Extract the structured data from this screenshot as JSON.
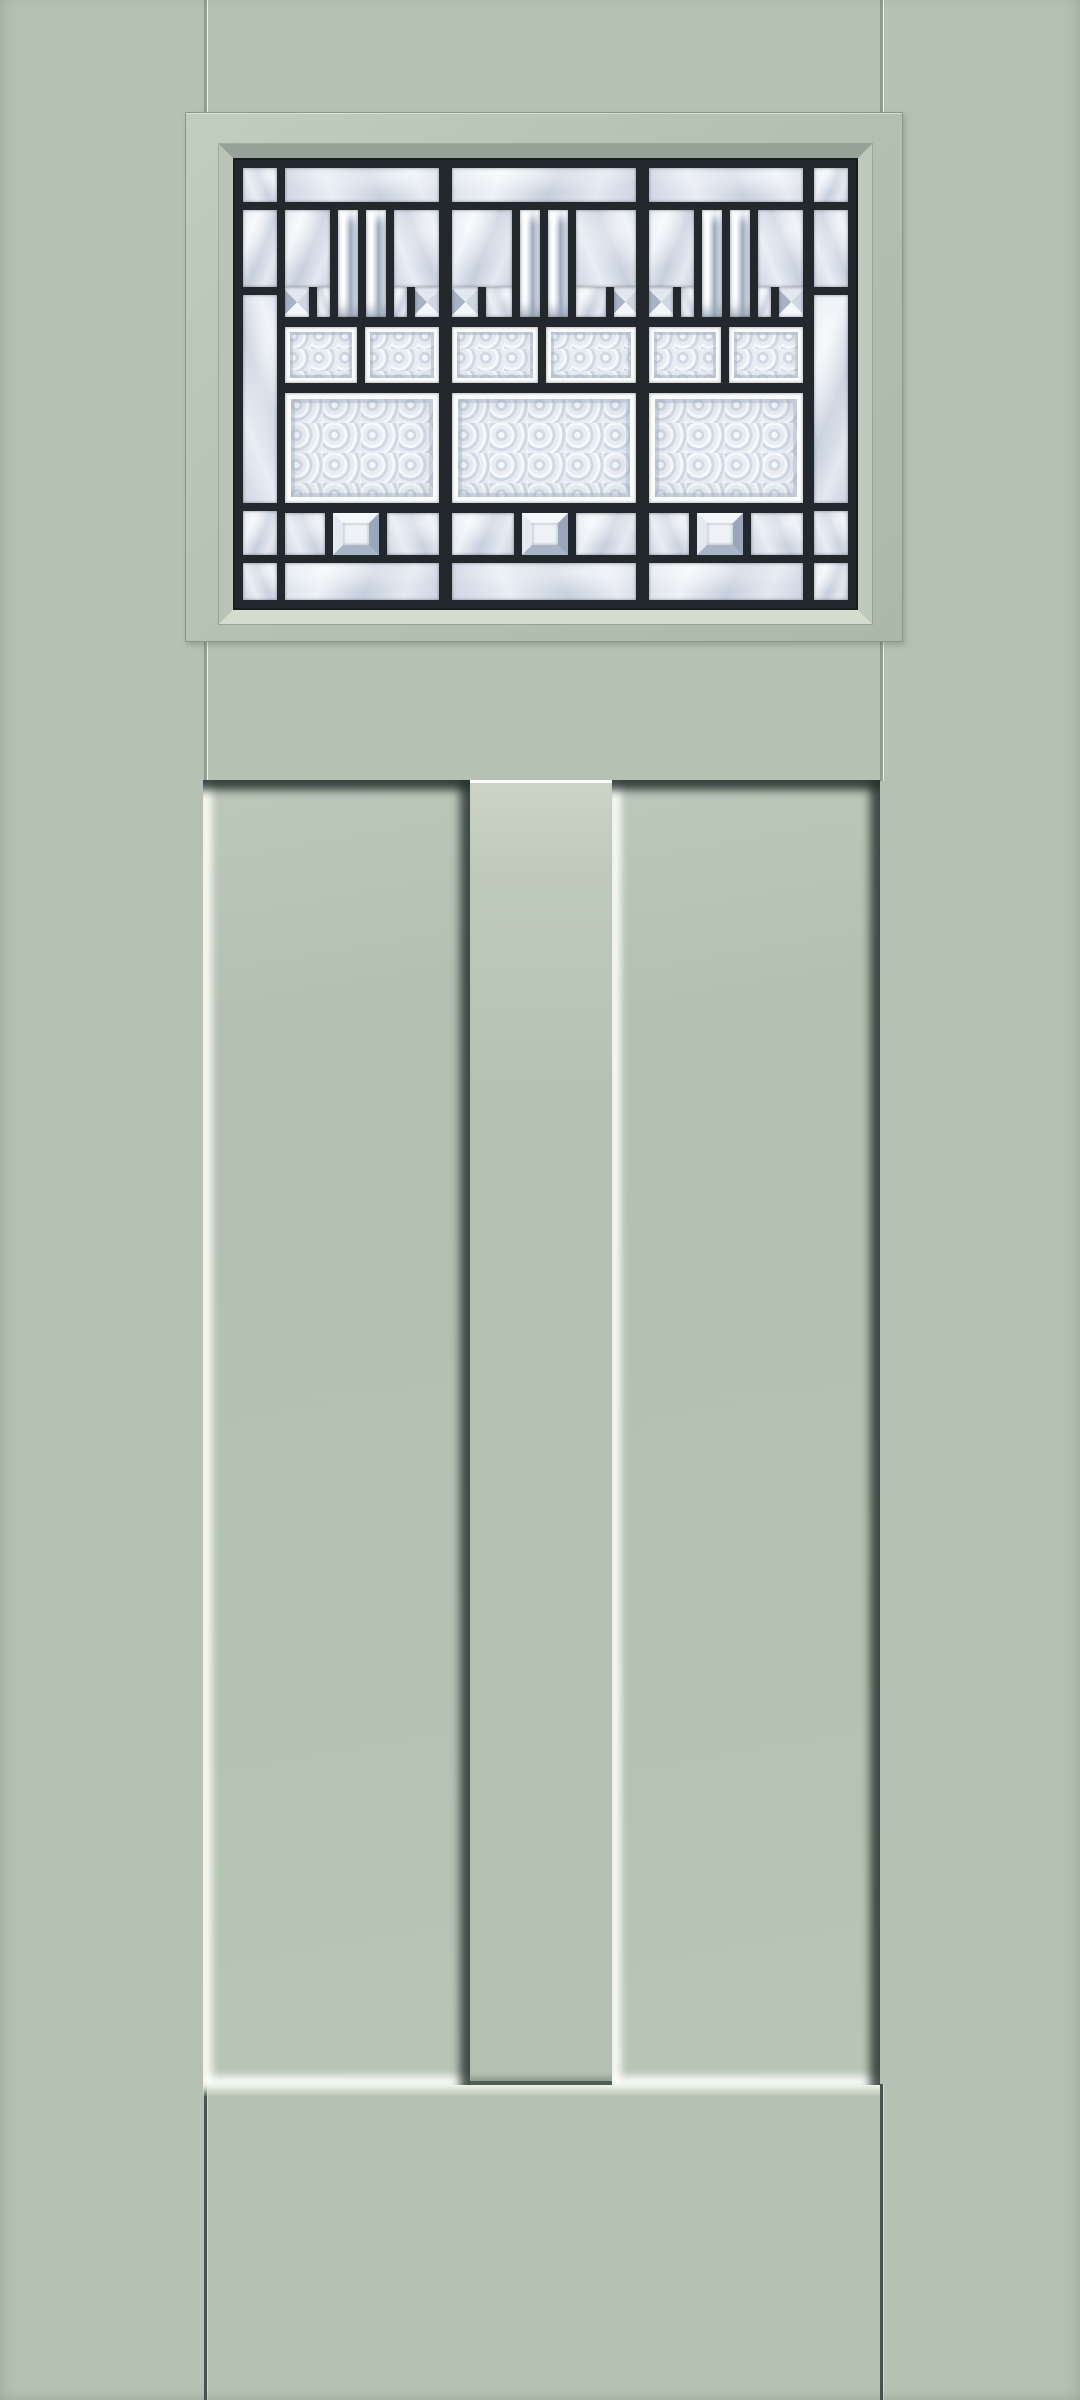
{
  "scene": {
    "description": "Product image of an exterior craftsman-style door, painted sage green, with a decorative leaded art-glass window above two tall recessed flat panels",
    "door_style": "craftsman two-panel, quarter-light decorative glass",
    "text_content": "none - image contains no text"
  },
  "colors": {
    "door_green": "#b5c2b3",
    "groove_gray": "#8a968b",
    "groove_dark": "#46544e",
    "molding_line": "#8b978c",
    "caming": "#22282b",
    "highlight": "#fafcf6",
    "recess_shadow": "#31403b",
    "glass_clear": "#dfe5ee",
    "glass_bevel_dark": "#9facbe",
    "glass_texture": "#e3e9f0"
  },
  "window": {
    "molding": {
      "shape": "rectangular flat molding",
      "color_ref": "door_green"
    },
    "glass": {
      "style": "craftsman leaded glass: side light columns, twin bevel prisms, dentil bevels, glue-chip blocks, large textured panes, bevel squares, clear border rows",
      "caming_color_ref": "caming",
      "pane_types": [
        "clear",
        "bar",
        "pyr",
        "bsq",
        "gr",
        "grb"
      ],
      "panes": [
        {
          "x": 10,
          "y": 10,
          "w": 34,
          "h": 34,
          "t": "clear"
        },
        {
          "x": 10,
          "y": 52,
          "w": 34,
          "h": 77,
          "t": "clear"
        },
        {
          "x": 10,
          "y": 137,
          "w": 34,
          "h": 208,
          "t": "clear"
        },
        {
          "x": 10,
          "y": 353,
          "w": 34,
          "h": 44,
          "t": "clear"
        },
        {
          "x": 10,
          "y": 405,
          "w": 34,
          "h": 37,
          "t": "clear"
        },
        {
          "x": 581,
          "y": 10,
          "w": 34,
          "h": 34,
          "t": "clear"
        },
        {
          "x": 581,
          "y": 52,
          "w": 34,
          "h": 77,
          "t": "clear"
        },
        {
          "x": 581,
          "y": 137,
          "w": 34,
          "h": 208,
          "t": "clear"
        },
        {
          "x": 581,
          "y": 353,
          "w": 34,
          "h": 44,
          "t": "clear"
        },
        {
          "x": 581,
          "y": 405,
          "w": 34,
          "h": 37,
          "t": "clear"
        },
        {
          "x": 52,
          "y": 10,
          "w": 154,
          "h": 34,
          "t": "clear"
        },
        {
          "x": 219,
          "y": 10,
          "w": 184,
          "h": 34,
          "t": "clear"
        },
        {
          "x": 416,
          "y": 10,
          "w": 154,
          "h": 34,
          "t": "clear"
        },
        {
          "x": 52,
          "y": 52,
          "w": 45,
          "h": 77,
          "t": "clear"
        },
        {
          "x": 161,
          "y": 52,
          "w": 45,
          "h": 77,
          "t": "clear"
        },
        {
          "x": 219,
          "y": 52,
          "w": 60,
          "h": 77,
          "t": "clear"
        },
        {
          "x": 343,
          "y": 52,
          "w": 60,
          "h": 77,
          "t": "clear"
        },
        {
          "x": 416,
          "y": 52,
          "w": 45,
          "h": 77,
          "t": "clear"
        },
        {
          "x": 525,
          "y": 52,
          "w": 45,
          "h": 77,
          "t": "clear"
        },
        {
          "x": 105,
          "y": 52,
          "w": 20,
          "h": 107,
          "t": "bar"
        },
        {
          "x": 133,
          "y": 52,
          "w": 20,
          "h": 107,
          "t": "bar"
        },
        {
          "x": 287,
          "y": 52,
          "w": 20,
          "h": 107,
          "t": "bar"
        },
        {
          "x": 315,
          "y": 52,
          "w": 20,
          "h": 107,
          "t": "bar"
        },
        {
          "x": 469,
          "y": 52,
          "w": 20,
          "h": 107,
          "t": "bar"
        },
        {
          "x": 497,
          "y": 52,
          "w": 20,
          "h": 107,
          "t": "bar"
        },
        {
          "x": 52,
          "y": 129,
          "w": 24,
          "h": 30,
          "t": "pyr"
        },
        {
          "x": 84,
          "y": 129,
          "w": 13,
          "h": 30,
          "t": "clear"
        },
        {
          "x": 161,
          "y": 129,
          "w": 13,
          "h": 30,
          "t": "clear"
        },
        {
          "x": 182,
          "y": 129,
          "w": 24,
          "h": 30,
          "t": "pyr"
        },
        {
          "x": 219,
          "y": 129,
          "w": 26,
          "h": 30,
          "t": "pyr"
        },
        {
          "x": 253,
          "y": 129,
          "w": 26,
          "h": 30,
          "t": "clear"
        },
        {
          "x": 343,
          "y": 129,
          "w": 30,
          "h": 30,
          "t": "clear"
        },
        {
          "x": 381,
          "y": 129,
          "w": 22,
          "h": 30,
          "t": "pyr"
        },
        {
          "x": 416,
          "y": 129,
          "w": 24,
          "h": 30,
          "t": "pyr"
        },
        {
          "x": 448,
          "y": 129,
          "w": 13,
          "h": 30,
          "t": "clear"
        },
        {
          "x": 525,
          "y": 129,
          "w": 13,
          "h": 30,
          "t": "clear"
        },
        {
          "x": 546,
          "y": 129,
          "w": 24,
          "h": 30,
          "t": "pyr"
        },
        {
          "x": 52,
          "y": 169,
          "w": 72,
          "h": 56,
          "t": "gr"
        },
        {
          "x": 132,
          "y": 169,
          "w": 74,
          "h": 56,
          "t": "gr"
        },
        {
          "x": 219,
          "y": 169,
          "w": 86,
          "h": 56,
          "t": "gr"
        },
        {
          "x": 313,
          "y": 169,
          "w": 90,
          "h": 56,
          "t": "gr"
        },
        {
          "x": 416,
          "y": 169,
          "w": 72,
          "h": 56,
          "t": "gr"
        },
        {
          "x": 496,
          "y": 169,
          "w": 74,
          "h": 56,
          "t": "gr"
        },
        {
          "x": 52,
          "y": 235,
          "w": 154,
          "h": 110,
          "t": "grb"
        },
        {
          "x": 219,
          "y": 235,
          "w": 184,
          "h": 110,
          "t": "grb"
        },
        {
          "x": 416,
          "y": 235,
          "w": 154,
          "h": 110,
          "t": "grb"
        },
        {
          "x": 52,
          "y": 355,
          "w": 40,
          "h": 42,
          "t": "clear"
        },
        {
          "x": 100,
          "y": 355,
          "w": 46,
          "h": 42,
          "t": "bsq"
        },
        {
          "x": 154,
          "y": 355,
          "w": 52,
          "h": 42,
          "t": "clear"
        },
        {
          "x": 219,
          "y": 355,
          "w": 62,
          "h": 42,
          "t": "clear"
        },
        {
          "x": 289,
          "y": 355,
          "w": 46,
          "h": 42,
          "t": "bsq"
        },
        {
          "x": 343,
          "y": 355,
          "w": 60,
          "h": 42,
          "t": "clear"
        },
        {
          "x": 416,
          "y": 355,
          "w": 40,
          "h": 42,
          "t": "clear"
        },
        {
          "x": 464,
          "y": 355,
          "w": 46,
          "h": 42,
          "t": "bsq"
        },
        {
          "x": 518,
          "y": 355,
          "w": 52,
          "h": 42,
          "t": "clear"
        },
        {
          "x": 52,
          "y": 405,
          "w": 154,
          "h": 37,
          "t": "clear"
        },
        {
          "x": 219,
          "y": 405,
          "w": 184,
          "h": 37,
          "t": "clear"
        },
        {
          "x": 416,
          "y": 405,
          "w": 154,
          "h": 37,
          "t": "clear"
        }
      ]
    }
  },
  "panels": {
    "count": 2,
    "style": "tall recessed flat panels, highlight on left/bottom edges, shadow on top/right edges",
    "center_stile": "flush stile between panels with light top edge and dark bottom edge"
  },
  "grooves": {
    "description": "vertical stile joint lines above the window molding and below the panels, at both sides"
  }
}
